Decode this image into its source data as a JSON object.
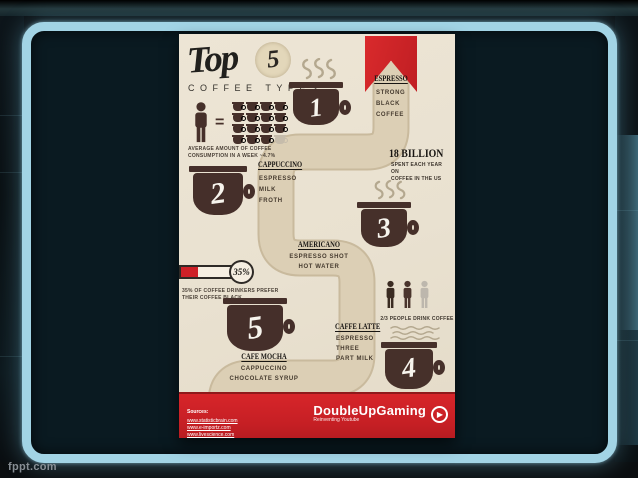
{
  "slide": {
    "watermark": "fppt.com"
  },
  "colors": {
    "accent_red": "#cd2027",
    "cup_brown": "#46302a",
    "path_tan": "#d9ccb2",
    "poster_bg": "#ebe3d3",
    "frame_blue": "#a2d4e5"
  },
  "poster": {
    "title": {
      "script": "Top",
      "number": "5",
      "subtitle": "COFFEE TYPES"
    },
    "consumption_stat": {
      "equals": "=",
      "caption1": "AVERAGE AMOUNT OF COFFEE",
      "caption2": "CONSUMPTION IN A WEEK ~4.7%"
    },
    "types": {
      "espresso": {
        "rank": "1",
        "name": "ESPRESSO",
        "d1": "STRONG",
        "d2": "BLACK",
        "d3": "COFFEE"
      },
      "cappuccino": {
        "rank": "2",
        "name": "CAPPUCCINO",
        "d1": "ESPRESSO",
        "d2": "MILK",
        "d3": "FROTH"
      },
      "americano": {
        "rank": "3",
        "name": "AMERICANO",
        "d1": "ESPRESSO SHOT",
        "d2": "HOT WATER"
      },
      "caffe_latte": {
        "rank": "4",
        "name": "CAFFE LATTE",
        "d1": "ESPRESSO",
        "d2": "THREE",
        "d3": "PART MILK"
      },
      "cafe_mocha": {
        "rank": "5",
        "name": "CAFE MOCHA",
        "d1": "CAPPUCCINO",
        "d2": "CHOCOLATE SYRUP"
      }
    },
    "billion_stat": {
      "value": "18 BILLION",
      "caption1": "SPENT EACH YEAR ON",
      "caption2": "COFFEE IN THE US"
    },
    "black_stat": {
      "value": "35%",
      "caption1": "35% OF COFFEE DRINKERS PREFER",
      "caption2": "THEIR COFFEE BLACK"
    },
    "drinkers_stat": {
      "caption": "2/3 PEOPLE DRINK COFFEE"
    },
    "footer": {
      "sources_label": "Sources:",
      "sources": [
        "www.statisticbrain.com",
        "www.e-importz.com",
        "www.livescience.com"
      ],
      "brand": "DoubleUpGaming",
      "brand_sub": "Reinventing Youtube",
      "play_glyph": "▶"
    }
  }
}
